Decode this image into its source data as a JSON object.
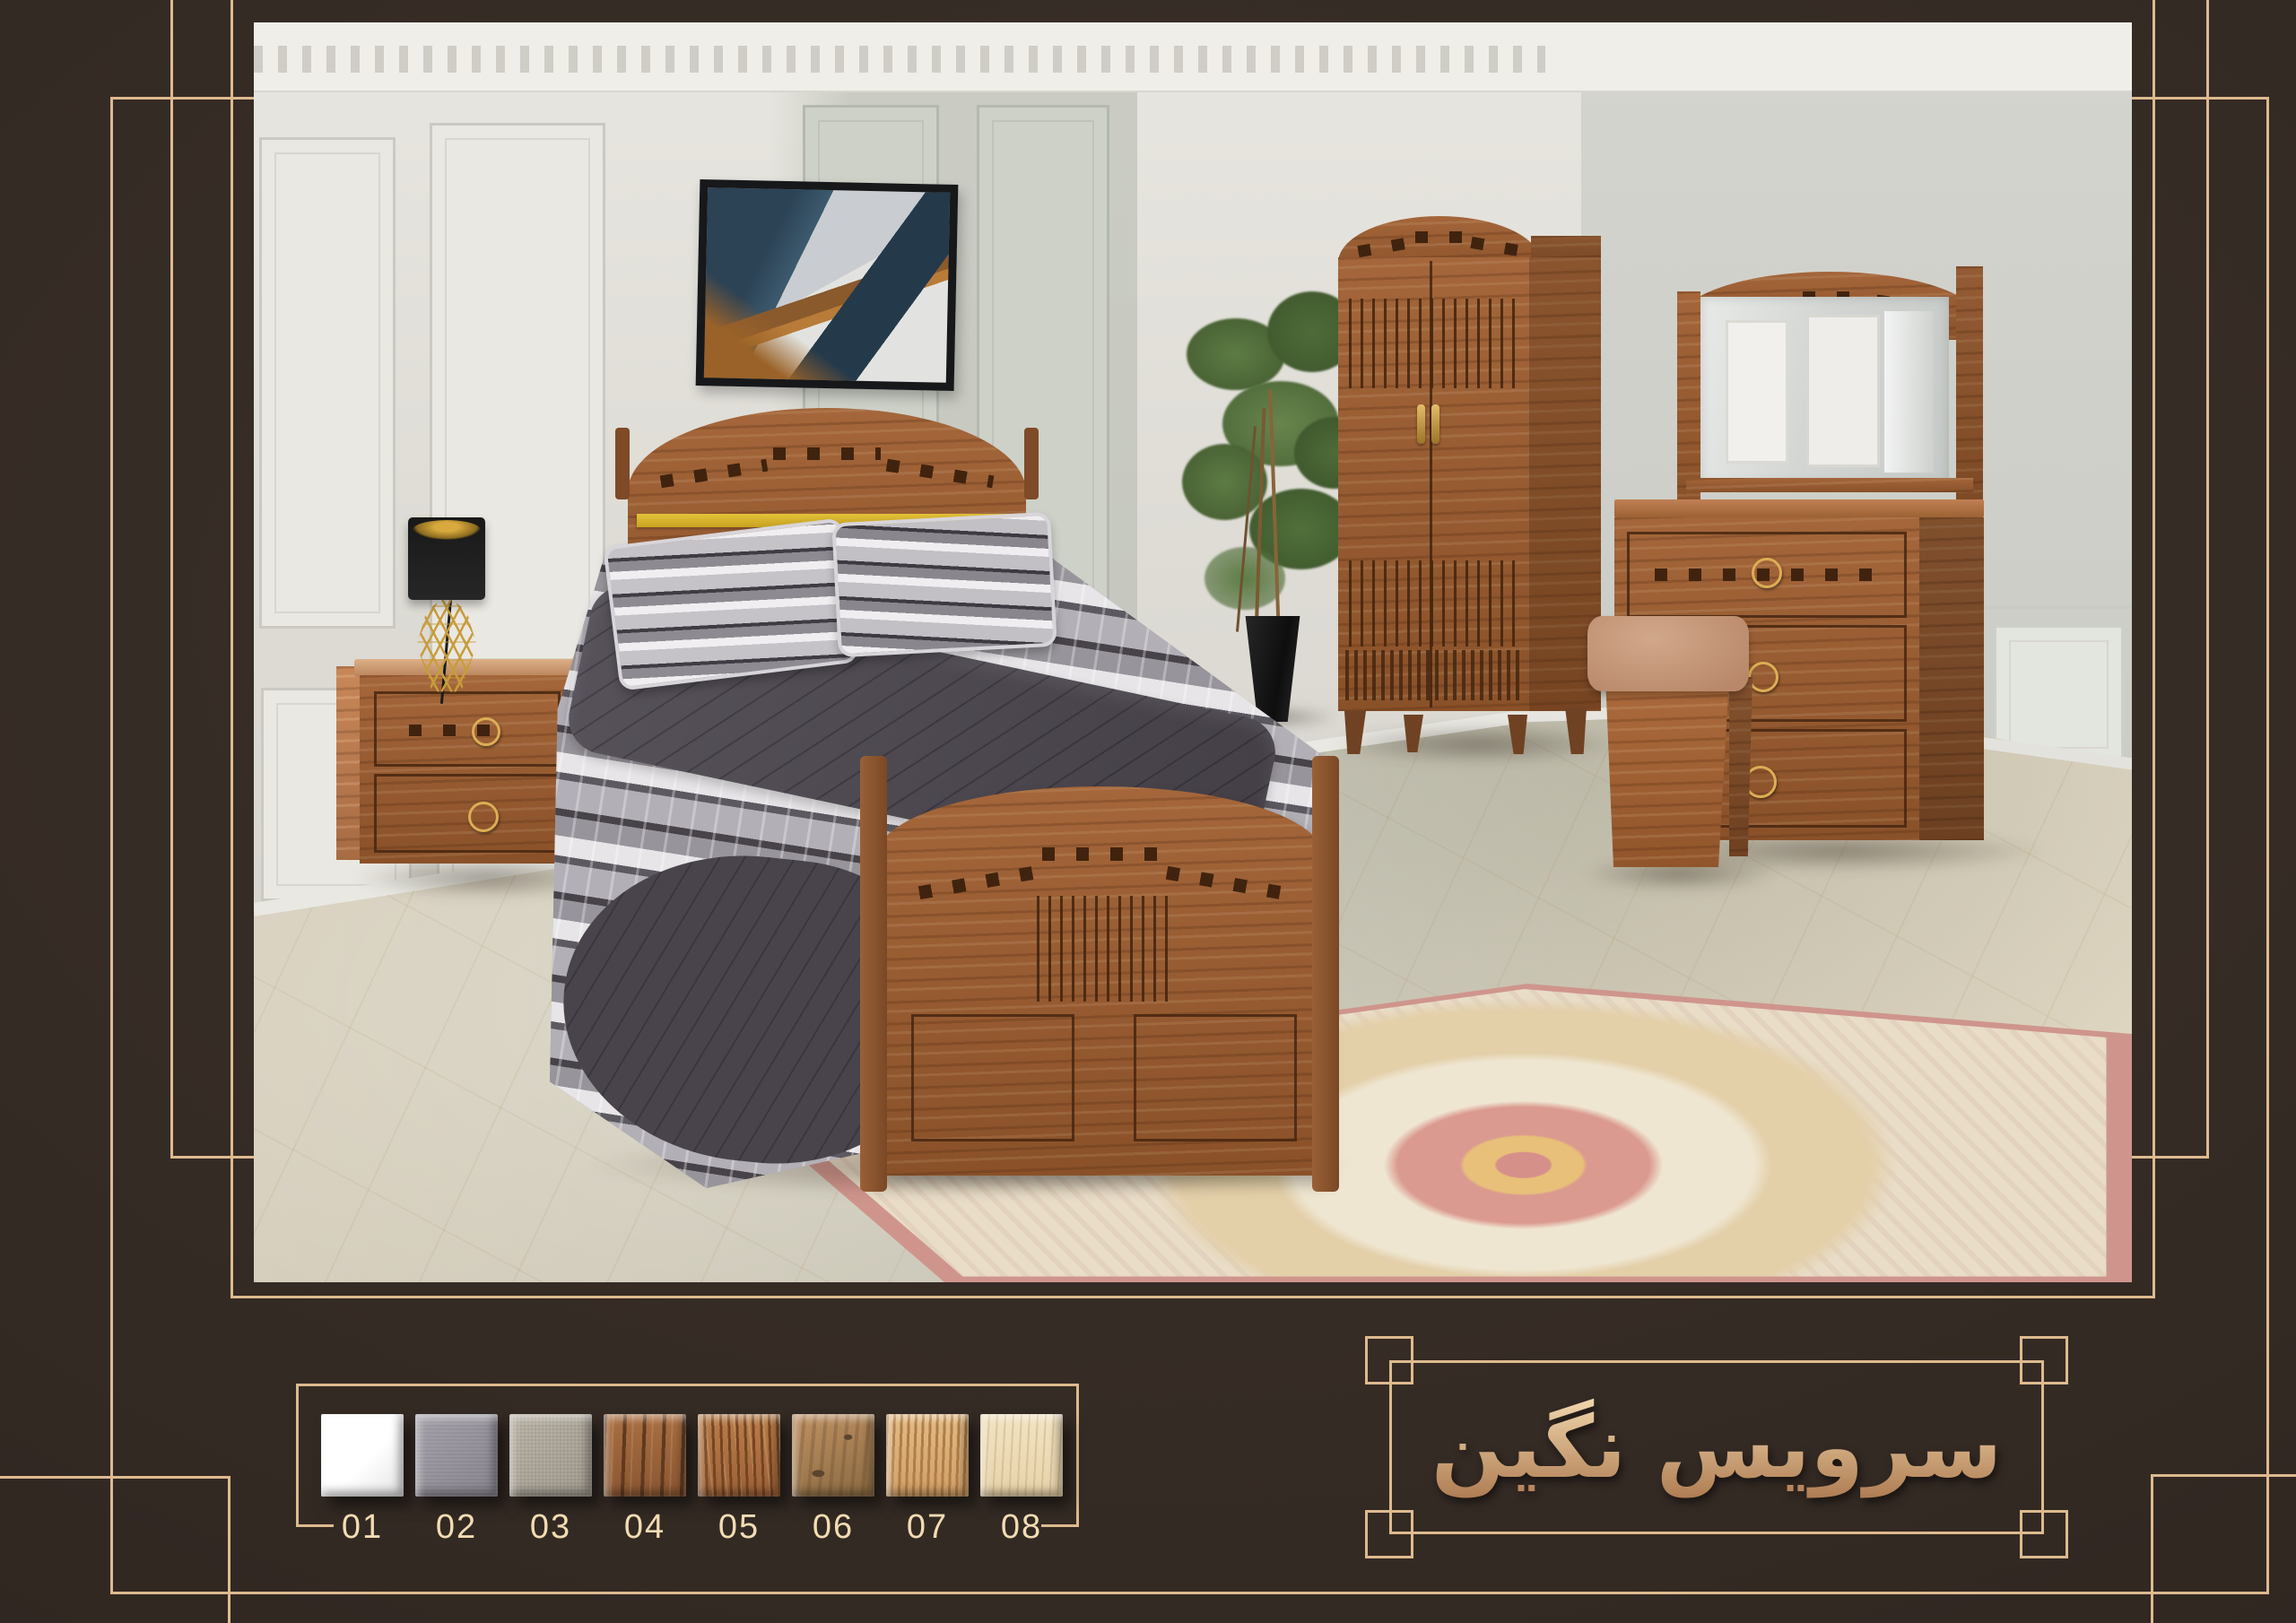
{
  "page": {
    "background_color": "#342a24",
    "accent_line_color": "#ddba8e",
    "label_color": "#f2dcb2"
  },
  "title": {
    "text": "سرویس نگین",
    "gradient": [
      "#f5dcb2",
      "#a56f45"
    ]
  },
  "swatches": {
    "items": [
      {
        "label": "01",
        "finish": "white-gloss",
        "colors": [
          "#fdfdfd",
          "#e4e4e4"
        ]
      },
      {
        "label": "02",
        "finish": "grey-fabric",
        "colors": [
          "#a09ca6",
          "#827e88"
        ]
      },
      {
        "label": "03",
        "finish": "beige-linen",
        "colors": [
          "#b7b0a3",
          "#9d968a"
        ]
      },
      {
        "label": "04",
        "finish": "dark-walnut",
        "colors": [
          "#8a5632",
          "#5f3a1f",
          "#a96f42"
        ]
      },
      {
        "label": "05",
        "finish": "medium-walnut",
        "colors": [
          "#9c6038",
          "#76451f",
          "#b97e4b"
        ]
      },
      {
        "label": "06",
        "finish": "rustic-oak",
        "colors": [
          "#bf9162",
          "#8a6a42",
          "#5c442e"
        ]
      },
      {
        "label": "07",
        "finish": "golden-oak",
        "colors": [
          "#cf9f66",
          "#b07c49",
          "#e2bc84"
        ]
      },
      {
        "label": "08",
        "finish": "light-maple",
        "colors": [
          "#e7d3ab",
          "#d6bd92",
          "#f1e3c2"
        ]
      }
    ]
  },
  "photo": {
    "scene_objects": [
      "paneled-wall",
      "crown-molding",
      "wall-art",
      "bed",
      "pillows",
      "quilt",
      "throw-blanket",
      "nightstand",
      "table-lamp",
      "house-plant",
      "planter",
      "wardrobe",
      "dresser",
      "mirror",
      "stool",
      "area-rug",
      "marble-floor"
    ]
  }
}
